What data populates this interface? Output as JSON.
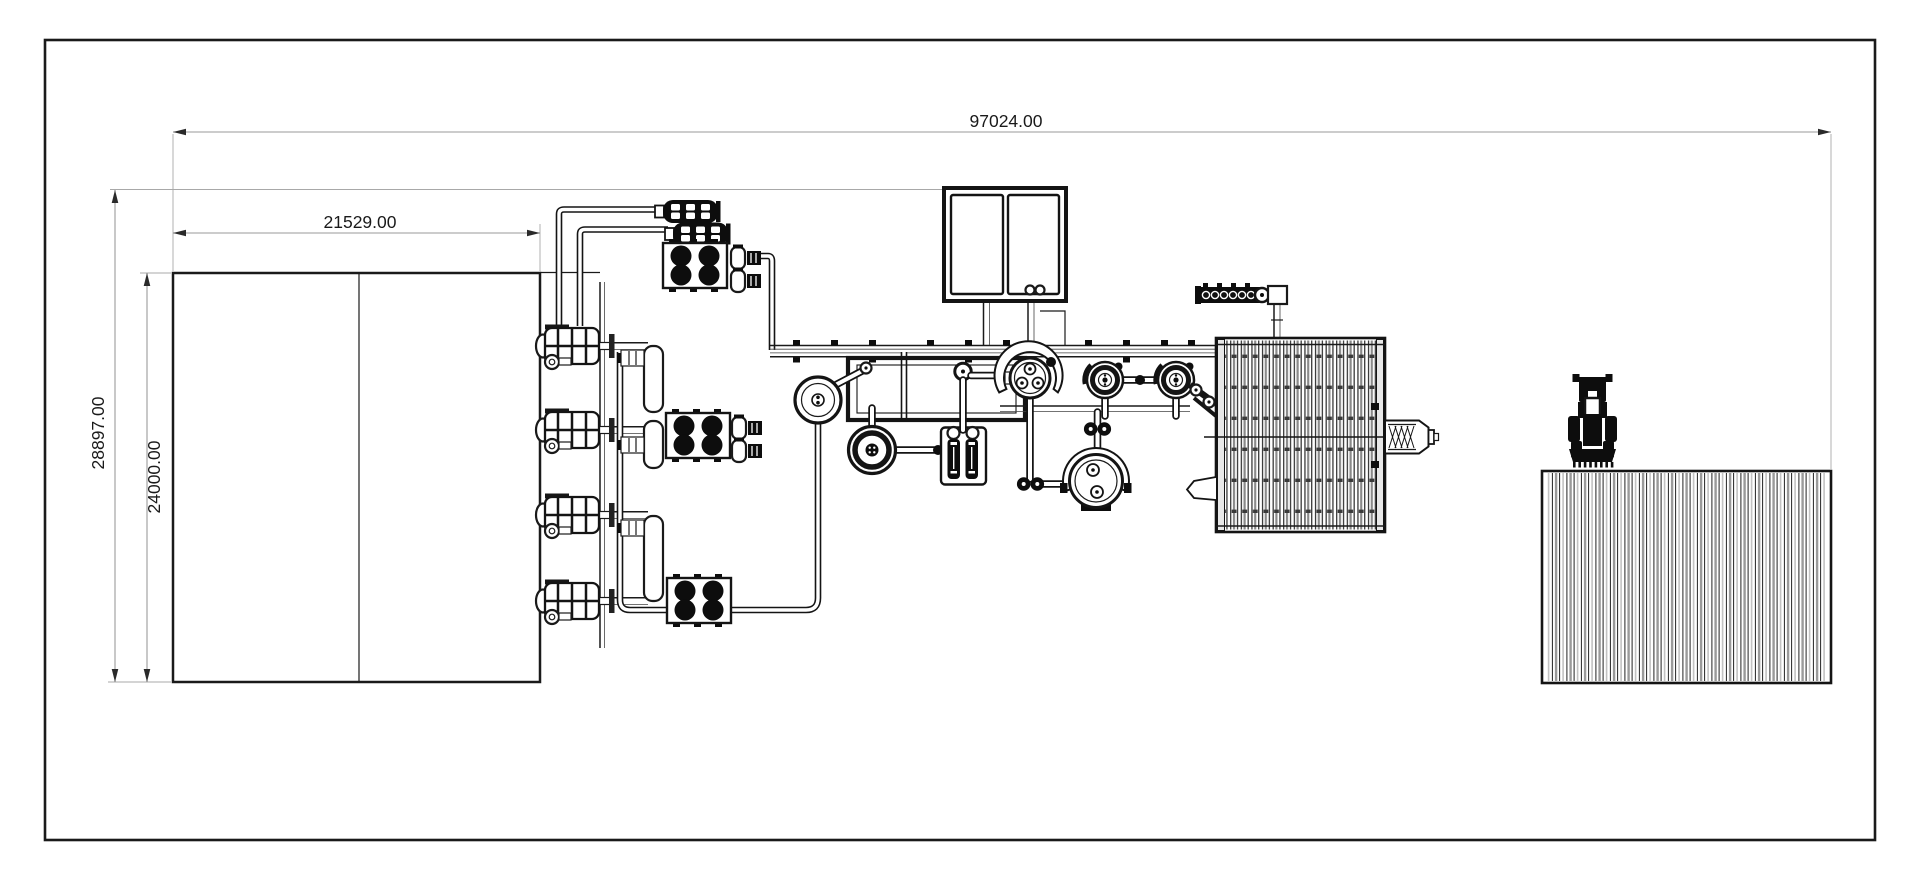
{
  "drawing": {
    "dimensions": {
      "overall_length": "97024.00",
      "building_length": "21529.00",
      "site_depth": "28897.00",
      "building_depth": "24000.00"
    },
    "colors": {
      "line": "#1a1a1a",
      "dim_line": "#9a9a9a",
      "machine_fill": "#0d0d0d",
      "background": "#ffffff"
    }
  }
}
